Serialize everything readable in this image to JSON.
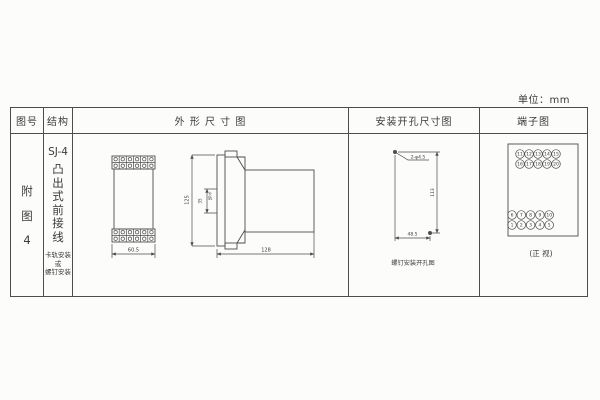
{
  "unit_label": "单位：mm",
  "headers": {
    "figure_no": "图号",
    "structure": "结构",
    "outline": "外 形 尺 寸 图",
    "mounting": "安装开孔尺寸图",
    "terminal": "端子图"
  },
  "figure_no": {
    "chars": [
      "附",
      "图",
      "4"
    ]
  },
  "structure": {
    "model": "SJ-4",
    "type_chars": [
      "凸",
      "出",
      "式",
      "前",
      "接",
      "线"
    ],
    "mounting_lines": [
      "卡轨安装",
      "或",
      "螺钉安装"
    ]
  },
  "outline": {
    "front_width": "60.5",
    "height": "125",
    "rail_width": "35",
    "rail_label": "卡轨",
    "depth": "128"
  },
  "mounting": {
    "hole_label": "2-φ4.5",
    "height_dim": "113",
    "width_dim": "48.5",
    "caption": "螺钉安装开孔图"
  },
  "terminal": {
    "rows": [
      [
        "11",
        "12",
        "13",
        "14",
        "15"
      ],
      [
        "16",
        "17",
        "18",
        "19",
        "20"
      ],
      [
        "6",
        "7",
        "8",
        "9",
        "10"
      ],
      [
        "1",
        "2",
        "3",
        "4",
        "5"
      ]
    ],
    "caption": "(正 视)"
  }
}
